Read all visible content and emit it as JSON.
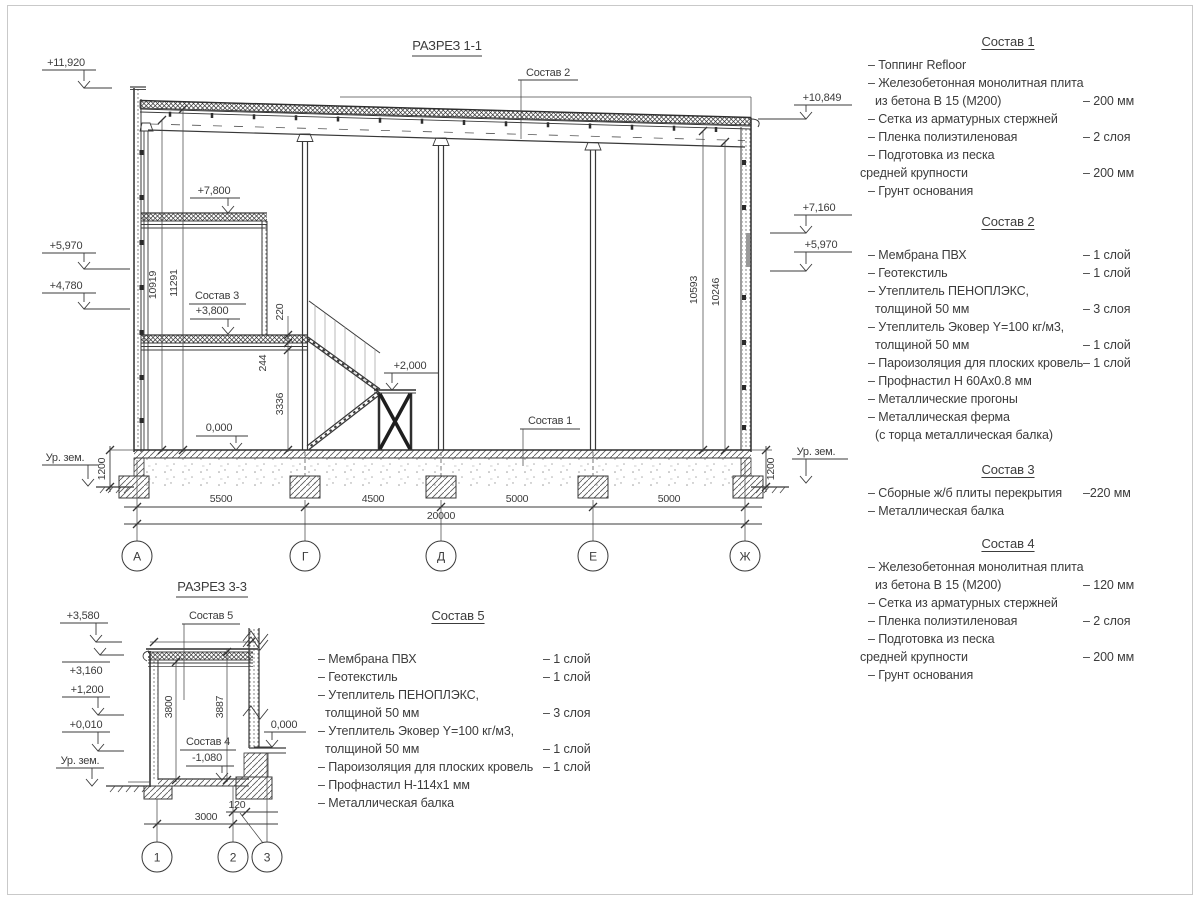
{
  "colors": {
    "line": "#3b3b3b",
    "text": "#3c3c3c",
    "frame": "#c9c9c9",
    "wall_insert_gray": "#9a9a9a"
  },
  "section11": {
    "title": "РАЗРЕЗ 1-1",
    "labels": {
      "sostav1": "Состав 1",
      "sostav2": "Состав 2",
      "sostav3": "Состав 3"
    },
    "elevations": {
      "e11920": "+11,920",
      "e5970l": "+5,970",
      "e4780": "+4,780",
      "e10849": "+10,849",
      "e7160": "+7,160",
      "e5970r": "+5,970",
      "e7800": "+7,800",
      "e3800": "+3,800",
      "e0000": "0,000",
      "e2000": "+2,000",
      "ground_left": "Ур. зем.",
      "ground_right": "Ур. зем."
    },
    "dims": {
      "v10919": "10919",
      "v11291": "11291",
      "v10593": "10593",
      "v10246": "10246",
      "v220": "220",
      "v244": "244",
      "v3336": "3336",
      "v1200l": "1200",
      "v1200r": "1200",
      "h5500": "5500",
      "h4500": "4500",
      "h5000a": "5000",
      "h5000b": "5000",
      "h20000": "20000"
    },
    "axes": [
      "А",
      "Г",
      "Д",
      "Е",
      "Ж"
    ]
  },
  "section33": {
    "title": "РАЗРЕЗ 3-3",
    "labels": {
      "sostav5": "Состав 5",
      "sostav4": "Состав 4"
    },
    "elevations": {
      "e3580": "+3,580",
      "e3160": "+3,160",
      "e1200": "+1,200",
      "e0010": "+0,010",
      "em1080": "-1,080",
      "e0000": "0,000",
      "ground": "Ур. зем."
    },
    "dims": {
      "v3800": "3800",
      "v3887": "3887",
      "h3000": "3000",
      "h120": "120"
    },
    "axes": [
      "1",
      "2",
      "3"
    ]
  },
  "compositions": [
    {
      "title": "Состав 1",
      "items": [
        {
          "text": "– Топпинг Refloor",
          "value": "",
          "indent": 1
        },
        {
          "text": "– Железобетонная  монолитная плита",
          "value": "",
          "indent": 1
        },
        {
          "text": "из бетона В 15 (М200)",
          "value": "– 200 мм",
          "indent": 2
        },
        {
          "text": "– Сетка из арматурных стержней",
          "value": "",
          "indent": 1
        },
        {
          "text": "– Пленка полиэтиленовая",
          "value": "– 2 слоя",
          "indent": 1
        },
        {
          "text": "– Подготовка из песка",
          "value": "",
          "indent": 1
        },
        {
          "text": "средней крупности",
          "value": "– 200 мм",
          "indent": 0
        },
        {
          "text": "– Грунт основания",
          "value": "",
          "indent": 1
        }
      ]
    },
    {
      "title": "Состав 2",
      "items": [
        {
          "text": "– Мембрана ПВХ",
          "value": "– 1 слой",
          "indent": 1
        },
        {
          "text": "– Геотекстиль",
          "value": "– 1 слой",
          "indent": 1
        },
        {
          "text": "– Утеплитель ПЕНОПЛЭКС,",
          "value": "",
          "indent": 1
        },
        {
          "text": "толщиной 50 мм",
          "value": "– 3 слоя",
          "indent": 2
        },
        {
          "text": "– Утеплитель Эковер Y=100 кг/м3,",
          "value": "",
          "indent": 1
        },
        {
          "text": "толщиной 50 мм",
          "value": "– 1 слой",
          "indent": 2
        },
        {
          "text": "– Пароизоляция для плоских кровель",
          "value": "– 1 слой",
          "indent": 1
        },
        {
          "text": "– Профнастил Н 60Ах0.8 мм",
          "value": "",
          "indent": 1
        },
        {
          "text": "– Металлические прогоны",
          "value": "",
          "indent": 1
        },
        {
          "text": "– Металлическая ферма",
          "value": "",
          "indent": 1
        },
        {
          "text": "(с торца металлическая балка)",
          "value": "",
          "indent": 2
        }
      ]
    },
    {
      "title": "Состав 3",
      "items": [
        {
          "text": "– Сборные ж/б плиты перекрытия",
          "value": "–220 мм",
          "indent": 1
        },
        {
          "text": "– Металлическая балка",
          "value": "",
          "indent": 1
        }
      ]
    },
    {
      "title": "Состав 4",
      "items": [
        {
          "text": "– Железобетонная  монолитная плита",
          "value": "",
          "indent": 1
        },
        {
          "text": "из бетона В 15 (М200)",
          "value": "– 120 мм",
          "indent": 2
        },
        {
          "text": "– Сетка из арматурных стержней",
          "value": "",
          "indent": 1
        },
        {
          "text": "– Пленка полиэтиленовая",
          "value": "– 2 слоя",
          "indent": 1
        },
        {
          "text": "– Подготовка из песка",
          "value": "",
          "indent": 1
        },
        {
          "text": "средней крупности",
          "value": "– 200 мм",
          "indent": 0
        },
        {
          "text": "– Грунт основания",
          "value": "",
          "indent": 1
        }
      ]
    },
    {
      "title": "Состав 5",
      "items": [
        {
          "text": "– Мембрана ПВХ",
          "value": "– 1 слой",
          "indent": 1
        },
        {
          "text": "– Геотекстиль",
          "value": "– 1 слой",
          "indent": 1
        },
        {
          "text": "– Утеплитель ПЕНОПЛЭКС,",
          "value": "",
          "indent": 1
        },
        {
          "text": "толщиной 50 мм",
          "value": "– 3 слоя",
          "indent": 2
        },
        {
          "text": "– Утеплитель Эковер Y=100 кг/м3,",
          "value": "",
          "indent": 1
        },
        {
          "text": "толщиной 50 мм",
          "value": "– 1 слой",
          "indent": 2
        },
        {
          "text": "– Пароизоляция для плоских кровель",
          "value": "– 1 слой",
          "indent": 1
        },
        {
          "text": "– Профнастил Н-114х1 мм",
          "value": "",
          "indent": 1
        },
        {
          "text": "– Металлическая балка",
          "value": "",
          "indent": 1
        }
      ]
    }
  ]
}
